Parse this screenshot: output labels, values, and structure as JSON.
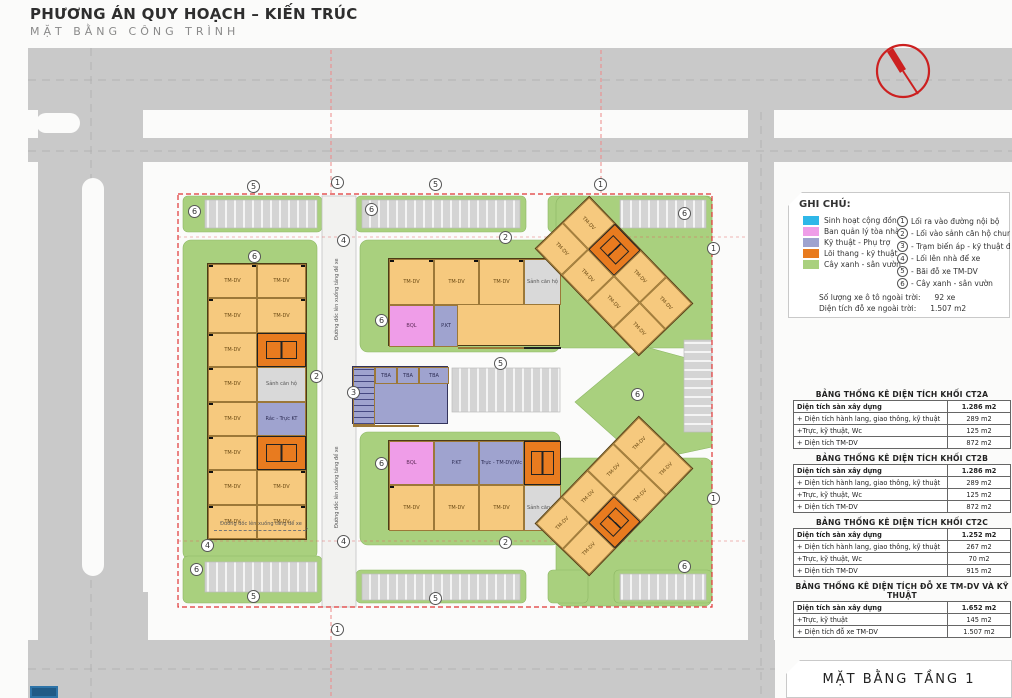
{
  "header": {
    "title": "PHƯƠNG ÁN QUY HOẠCH – KIẾN TRÚC",
    "subtitle": "MẶT BẰNG CÔNG TRÌNH"
  },
  "footer": {
    "title": "MẶT BẰNG TẦNG 1"
  },
  "colors": {
    "road": "#c9c9c9",
    "green": "#a9d07e",
    "unit": "#f6c97e",
    "core": "#e87b1f",
    "tech": "#9fa3cf",
    "management": "#ef9de8",
    "community": "#2fb7e8",
    "boundary": "#e03535"
  },
  "legend": {
    "title": "GHI CHÚ:",
    "swatches": [
      {
        "color": "#2fb7e8",
        "label": "Sinh hoạt cộng đồng"
      },
      {
        "color": "#ef9de8",
        "label": "Ban quản lý tòa nhà"
      },
      {
        "color": "#9fa3cf",
        "label": "Kỹ thuật - Phụ trợ"
      },
      {
        "color": "#e87b1f",
        "label": "Lõi thang - kỹ thuật"
      },
      {
        "color": "#a9d07e",
        "label": "Cây xanh - sân vườn"
      }
    ],
    "numbered": [
      {
        "num": "1",
        "label": "Lối ra vào đường nội bộ"
      },
      {
        "num": "2",
        "label": "- Lối vào sảnh căn hộ chung cư"
      },
      {
        "num": "3",
        "label": "- Trạm biến áp - kỹ thuật điện"
      },
      {
        "num": "4",
        "label": "- Lối lên nhà để xe"
      },
      {
        "num": "5",
        "label": "- Bãi đỗ xe TM-DV"
      },
      {
        "num": "6",
        "label": "- Cây xanh - sân vườn"
      }
    ],
    "stats": [
      {
        "label": "Số lượng xe ô tô ngoài trời:",
        "value": "92 xe"
      },
      {
        "label": "Diện tích đỗ xe ngoài trời:",
        "value": "1.507 m2"
      }
    ]
  },
  "tables": [
    {
      "title": "BẢNG THỐNG KÊ DIỆN TÍCH KHỐI CT2A",
      "rows": [
        {
          "label": "Diện tích sàn xây dựng",
          "value": "1.286 m2"
        },
        {
          "label": "+ Diện tích hành lang, giao thông, kỹ thuật",
          "value": "289 m2"
        },
        {
          "label": "+Trực, kỹ thuật, Wc",
          "value": "125 m2"
        },
        {
          "label": "+ Diện tích TM-DV",
          "value": "872 m2"
        }
      ]
    },
    {
      "title": "BẢNG THỐNG KÊ DIỆN TÍCH KHỐI CT2B",
      "rows": [
        {
          "label": "Diện tích sàn xây dựng",
          "value": "1.286 m2"
        },
        {
          "label": "+ Diện tích hành lang, giao thông, kỹ thuật",
          "value": "289 m2"
        },
        {
          "label": "+Trực, kỹ thuật, Wc",
          "value": "125 m2"
        },
        {
          "label": "+ Diện tích TM-DV",
          "value": "872 m2"
        }
      ]
    },
    {
      "title": "BẢNG THỐNG KÊ DIỆN TÍCH KHỐI CT2C",
      "rows": [
        {
          "label": "Diện tích sàn xây dựng",
          "value": "1.252 m2"
        },
        {
          "label": "+ Diện tích hành lang, giao thông, kỹ thuật",
          "value": "267 m2"
        },
        {
          "label": "+Trực, kỹ thuật, Wc",
          "value": "70 m2"
        },
        {
          "label": "+ Diện tích TM-DV",
          "value": "915 m2"
        }
      ]
    },
    {
      "title": "BẢNG THỐNG KÊ DIỆN TÍCH ĐỖ XE TM-DV VÀ KỸ THUẬT",
      "rows": [
        {
          "label": "Diện tích sàn xây dựng",
          "value": "1.652 m2"
        },
        {
          "label": "+Trực, kỹ thuật",
          "value": "145 m2"
        },
        {
          "label": "+ Diện tích đỗ xe TM-DV",
          "value": "1.507 m2"
        }
      ]
    }
  ],
  "plan": {
    "labels": {
      "tmdv": "TM-DV",
      "lobby": "Sảnh căn hộ",
      "bql": "BQL",
      "pkt": "P.KT",
      "truc": "Trực - TM-DV/Wc",
      "rac": "Rác - Trực KT",
      "tba": "TBA",
      "mpd": "MPĐ",
      "ramp": "Đường dốc lên xuống tầng để xe"
    },
    "markers": [
      {
        "n": "5"
      },
      {
        "n": "1"
      },
      {
        "n": "5"
      },
      {
        "n": "1"
      },
      {
        "n": "6"
      },
      {
        "n": "6"
      },
      {
        "n": "6"
      },
      {
        "n": "6"
      },
      {
        "n": "4"
      },
      {
        "n": "2"
      },
      {
        "n": "6"
      },
      {
        "n": "2"
      },
      {
        "n": "3"
      },
      {
        "n": "5"
      },
      {
        "n": "6"
      },
      {
        "n": "6"
      },
      {
        "n": "1"
      },
      {
        "n": "1"
      },
      {
        "n": "2"
      },
      {
        "n": "4"
      },
      {
        "n": "4"
      },
      {
        "n": "6"
      },
      {
        "n": "6"
      },
      {
        "n": "5"
      },
      {
        "n": "5"
      },
      {
        "n": "1"
      }
    ]
  }
}
